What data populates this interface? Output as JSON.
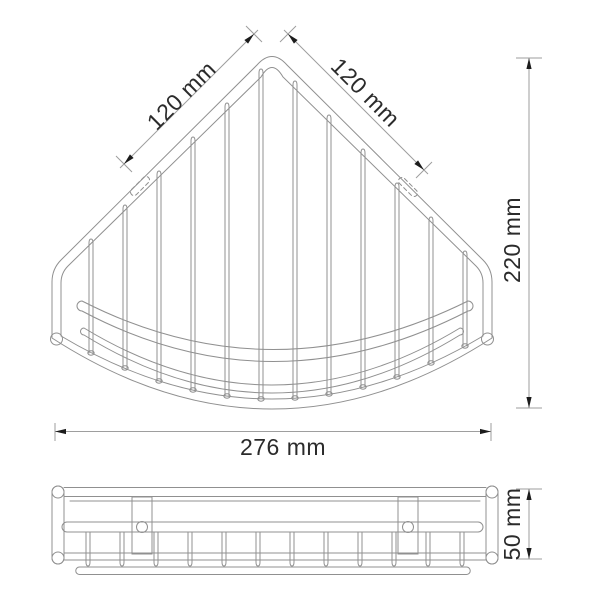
{
  "page": {
    "background": "#ffffff"
  },
  "drawing": {
    "kind": "technical-drawing",
    "views": {
      "top": {
        "dims": {
          "left_edge": "120 mm",
          "right_edge": "120 mm",
          "depth": "220 mm",
          "width": "276 mm"
        }
      },
      "front": {
        "dims": {
          "height": "50 mm"
        }
      }
    },
    "colors": {
      "geometry_line": "#909090",
      "dim_line": "#9e9e9e",
      "arrow": "#1c1c1c",
      "text": "#2b2b2b"
    }
  }
}
